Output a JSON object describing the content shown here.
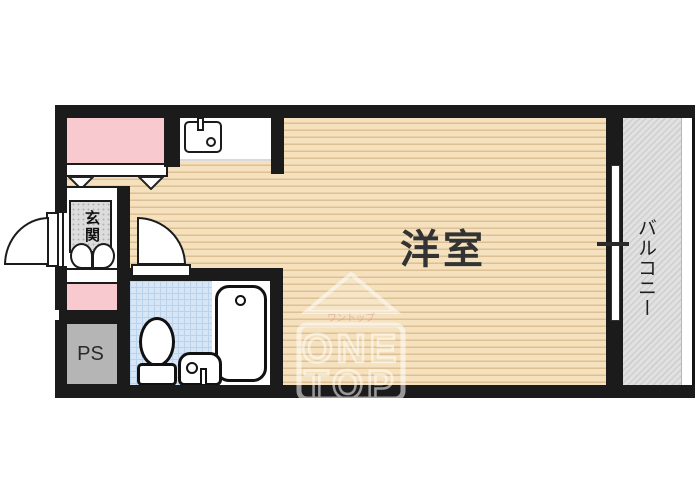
{
  "floorplan": {
    "type": "studio-apartment-floor-plan",
    "labels": {
      "western_room": "洋室",
      "balcony": "バルコニー",
      "entrance": "玄関",
      "pipe_space": "PS"
    },
    "watermark": {
      "kana": "ワントップ",
      "line1": "ONE",
      "line2": "TOP"
    },
    "colors": {
      "wall": "#1b1b1b",
      "wood_floor": "#f5e1bd",
      "wood_stripe": "#ddc094",
      "closet_pink": "#f8cacf",
      "bathroom_blue": "#d7e6f6",
      "balcony_gray": "#dedede",
      "entrance_gray": "#dcdcdc",
      "pipe_space_gray": "#b5b5b5",
      "watermark_kana_red": "#d98f8f"
    }
  }
}
